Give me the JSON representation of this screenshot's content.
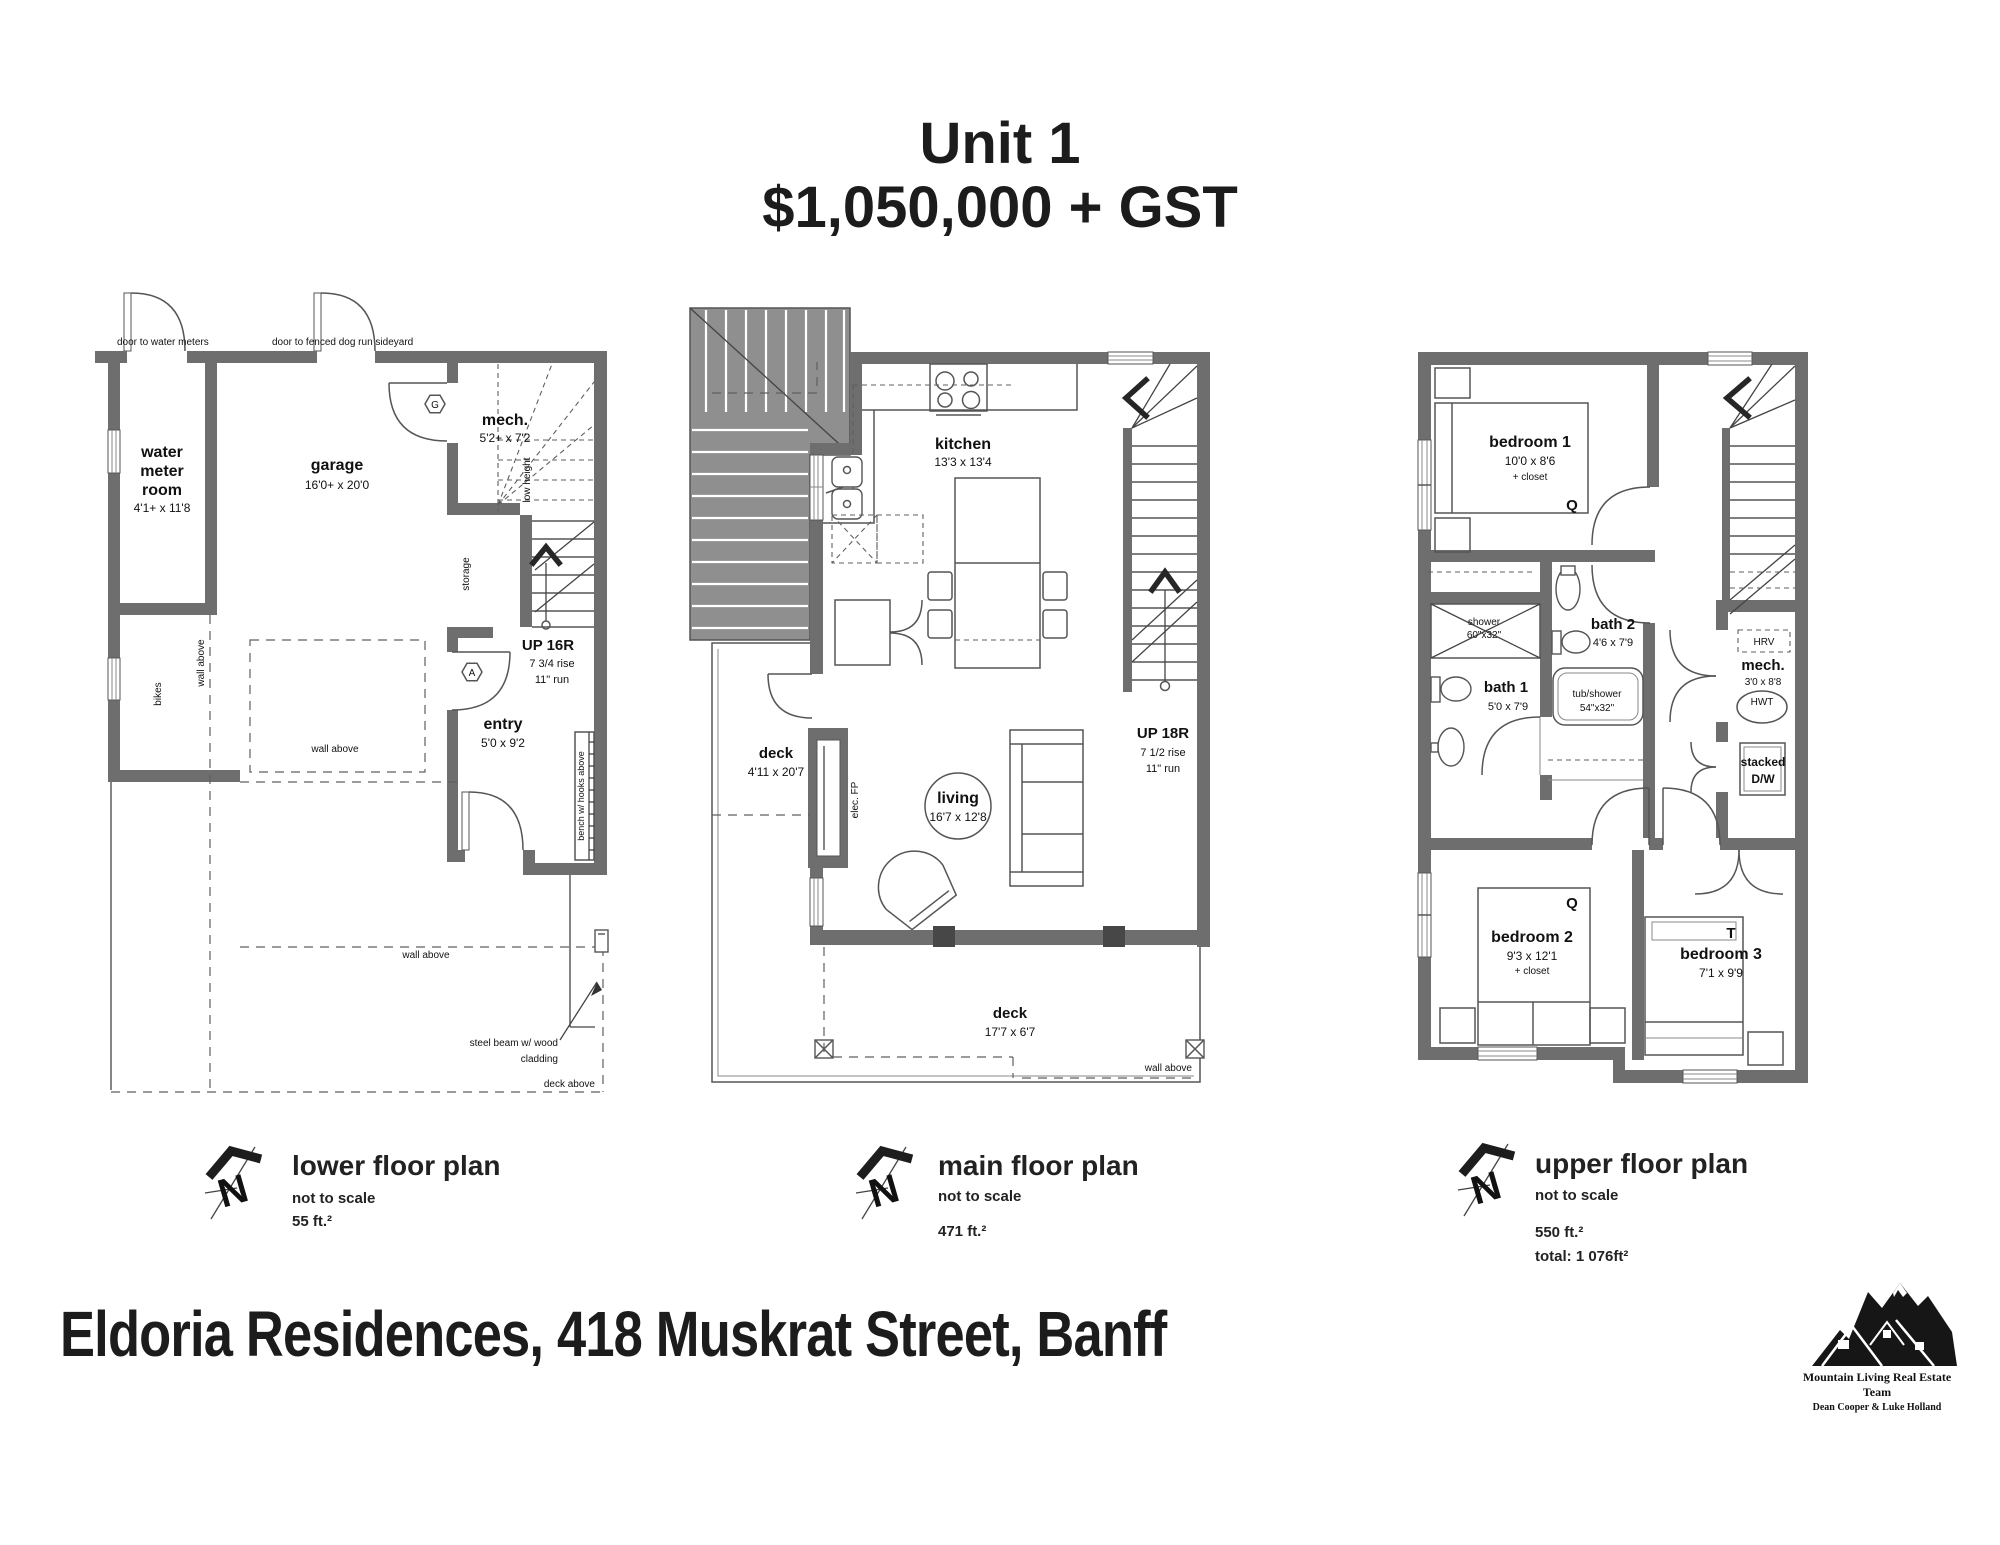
{
  "title": {
    "line1": "Unit 1",
    "line2": "$1,050,000 + GST"
  },
  "compass_n": "N",
  "legends": [
    {
      "name": "lower floor plan",
      "scale": "not to scale",
      "area": "55 ft.²"
    },
    {
      "name": "main floor plan",
      "scale": "not to scale",
      "area": "471 ft.²"
    },
    {
      "name": "upper floor plan",
      "scale": "not to scale",
      "area": "550 ft.²",
      "total": "total: 1 076ft²"
    }
  ],
  "footer": {
    "address": "Eldoria Residences, 418 Muskrat Street, Banff"
  },
  "logo": {
    "team": "Mountain Living Real Estate Team",
    "agents": "Dean Cooper & Luke Holland"
  },
  "lower_plan": {
    "door_note_1": "door to water meters",
    "door_note_2": "door to fenced dog run sideyard",
    "water_meter_1": "water",
    "water_meter_2": "meter",
    "water_meter_3": "room",
    "water_meter_dims": "4'1+ x 11'8",
    "garage": "garage",
    "garage_dims": "16'0+ x 20'0",
    "mech": "mech.",
    "mech_dims": "5'2+ x 7'2",
    "low_height": "low height",
    "storage": "storage",
    "stairs": "UP 16R",
    "stairs_rise": "7 3/4 rise",
    "stairs_run": "11\" run",
    "entry": "entry",
    "entry_dims": "5'0 x 9'2",
    "bikes": "bikes",
    "wall_above_left": "wall above",
    "wall_above_mid": "wall above",
    "wall_above_bottom": "wall above",
    "bench": "bench w/ hooks above",
    "steel_beam_1": "steel beam w/ wood",
    "steel_beam_2": "cladding",
    "deck_above": "deck above",
    "tag_g": "G",
    "tag_a": "A"
  },
  "main_plan": {
    "kitchen": "kitchen",
    "kitchen_dims": "13'3 x 13'4",
    "living": "living",
    "living_dims": "16'7 x 12'8",
    "deck_side": "deck",
    "deck_side_dims": "4'11 x 20'7",
    "deck_bottom": "deck",
    "deck_bottom_dims": "17'7 x 6'7",
    "stairs": "UP 18R",
    "stairs_rise": "7 1/2 rise",
    "stairs_run": "11\" run",
    "elec_fp": "elec. FP",
    "wall_above": "wall above"
  },
  "upper_plan": {
    "bedroom1": "bedroom 1",
    "bedroom1_dims": "10'0 x 8'6",
    "bedroom1_closet": "+ closet",
    "bedroom1_bed": "Q",
    "bath2": "bath 2",
    "bath2_dims": "4'6 x 7'9",
    "bath1": "bath 1",
    "bath1_dims": "5'0 x 7'9",
    "shower_1": "shower",
    "shower_2": "60\"x32\"",
    "tub_1": "tub/shower",
    "tub_2": "54\"x32\"",
    "hrv": "HRV",
    "mech": "mech.",
    "mech_dims": "3'0 x 8'8",
    "hwt": "HWT",
    "laundry_1": "stacked",
    "laundry_2": "D/W",
    "bedroom2": "bedroom 2",
    "bedroom2_dims": "9'3 x 12'1",
    "bedroom2_closet": "+ closet",
    "bedroom2_bed": "Q",
    "bedroom3": "bedroom 3",
    "bedroom3_dims": "7'1 x 9'9",
    "bedroom3_bed": "T"
  }
}
